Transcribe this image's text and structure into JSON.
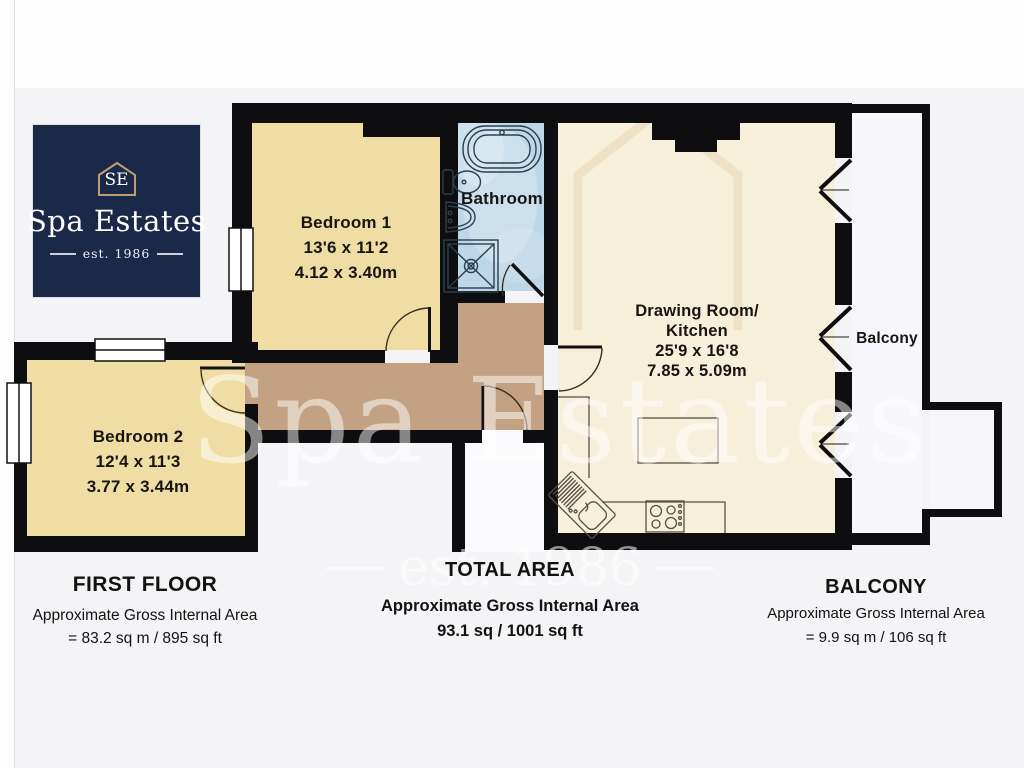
{
  "plan": {
    "wall_color": "#0e0d0f",
    "background": "#f4f3f6",
    "page_background": "#fdfdfe",
    "outside_fill": "#fbfbfd"
  },
  "logo": {
    "name": "Spa Estates",
    "monogram": "SE",
    "established": "est. 1986",
    "bg": "#1b2948",
    "accent": "#c29d72"
  },
  "watermark": {
    "name": "Spa Estates",
    "established": "est. 1986"
  },
  "rooms": {
    "bedroom1": {
      "label": "Bedroom 1",
      "dims_imperial": "13'6 x 11'2",
      "dims_metric": "4.12 x 3.40m",
      "fill": "#f0dda4"
    },
    "bedroom2": {
      "label": "Bedroom 2",
      "dims_imperial": "12'4 x 11'3",
      "dims_metric": "3.77 x 3.44m",
      "fill": "#f0dda4"
    },
    "bathroom": {
      "label": "Bathroom",
      "fill": "#bdd6e8"
    },
    "drawing_room": {
      "label_line1": "Drawing Room/",
      "label_line2": "Kitchen",
      "dims_imperial": "25'9 x 16'8",
      "dims_metric": "7.85 x 5.09m",
      "fill": "#f6efda"
    },
    "hallway": {
      "fill": "#c2a283"
    },
    "balcony": {
      "label": "Balcony",
      "fill": "#f7f6fa"
    }
  },
  "summary": {
    "first_floor": {
      "title": "FIRST FLOOR",
      "area_label": "Approximate Gross Internal Area",
      "area_value": "= 83.2 sq m / 895 sq ft"
    },
    "total_area": {
      "title": "TOTAL AREA",
      "area_label": "Approximate Gross Internal Area",
      "area_value": "93.1 sq / 1001 sq ft"
    },
    "balcony": {
      "title": "BALCONY",
      "area_label": "Approximate Gross Internal Area",
      "area_value": "= 9.9 sq m / 106 sq ft"
    }
  }
}
